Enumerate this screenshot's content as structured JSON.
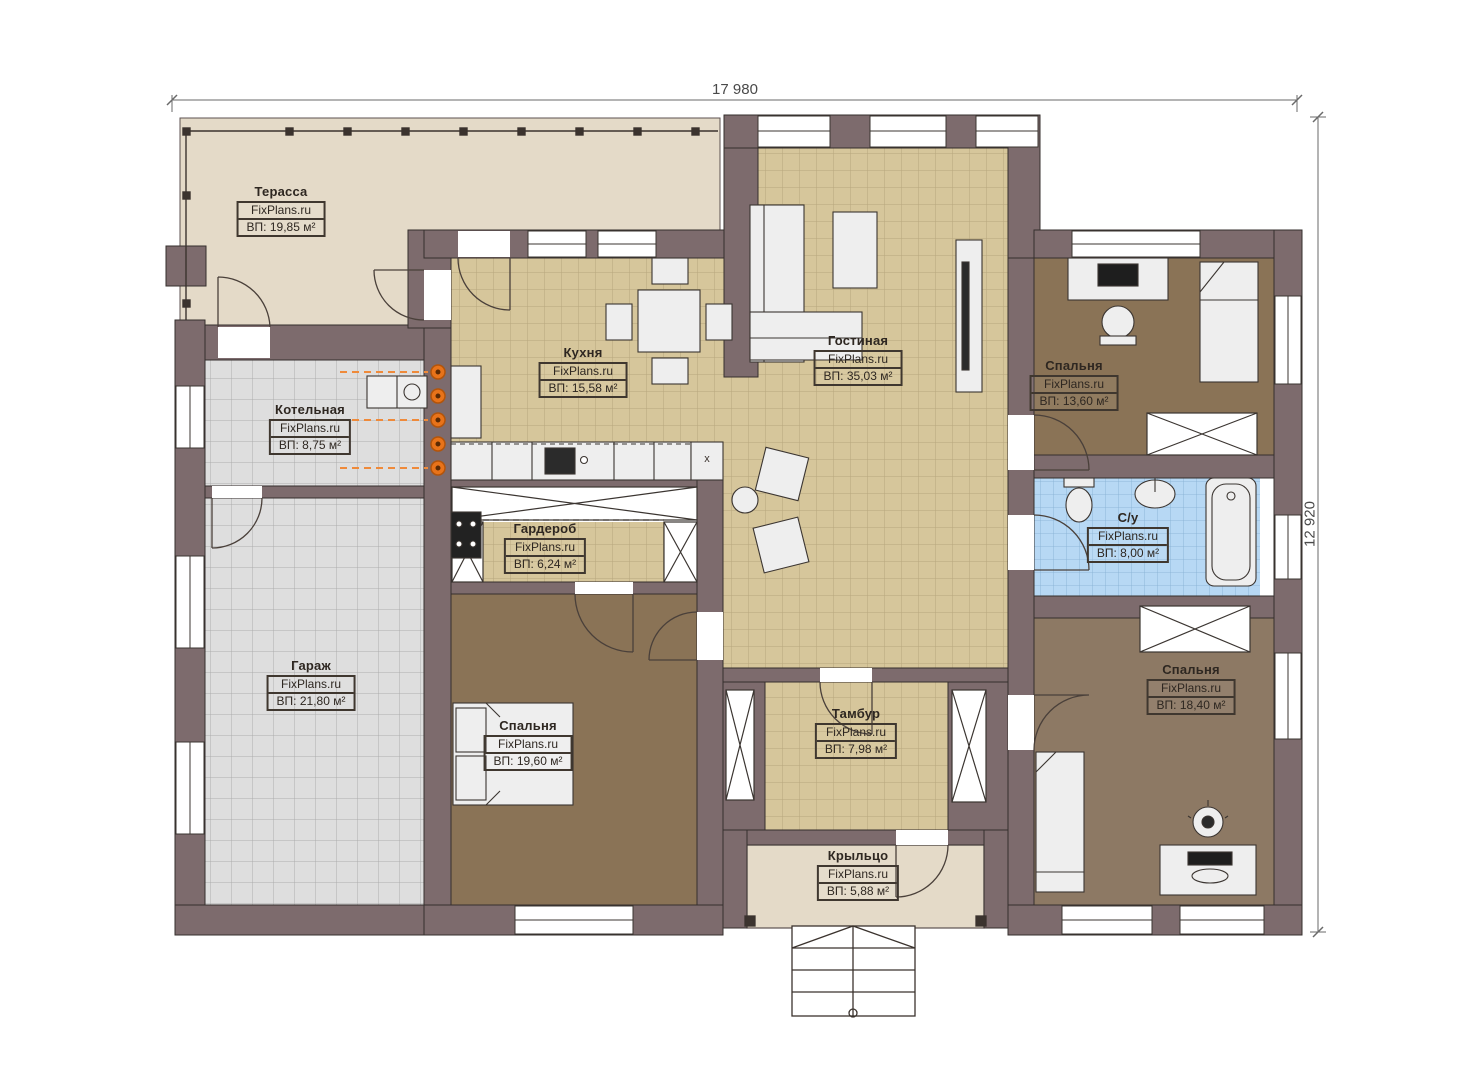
{
  "title": "Floor plan",
  "dimensions": {
    "top": "17 980",
    "right": "12 920"
  },
  "shaft": {
    "label": "x"
  },
  "watermark": "FixPlans.ru",
  "rooms": [
    {
      "id": "terrace",
      "name": "Терасса",
      "site": "FixPlans.ru",
      "area": "ВП: 19,85 м²"
    },
    {
      "id": "kitchen",
      "name": "Кухня",
      "site": "FixPlans.ru",
      "area": "ВП: 15,58 м²"
    },
    {
      "id": "living-room",
      "name": "Гостиная",
      "site": "FixPlans.ru",
      "area": "ВП: 35,03 м²"
    },
    {
      "id": "bedroom-top-right",
      "name": "Спальня",
      "site": "FixPlans.ru",
      "area": "ВП: 13,60 м²"
    },
    {
      "id": "boiler-room",
      "name": "Котельная",
      "site": "FixPlans.ru",
      "area": "ВП: 8,75 м²"
    },
    {
      "id": "wardrobe",
      "name": "Гардероб",
      "site": "FixPlans.ru",
      "area": "ВП: 6,24 м²"
    },
    {
      "id": "bathroom",
      "name": "С/у",
      "site": "FixPlans.ru",
      "area": "ВП: 8,00 м²"
    },
    {
      "id": "garage",
      "name": "Гараж",
      "site": "FixPlans.ru",
      "area": "ВП: 21,80 м²"
    },
    {
      "id": "bedroom-left",
      "name": "Спальня",
      "site": "FixPlans.ru",
      "area": "ВП: 19,60 м²"
    },
    {
      "id": "vestibule",
      "name": "Тамбур",
      "site": "FixPlans.ru",
      "area": "ВП: 7,98 м²"
    },
    {
      "id": "bedroom-bottom-right",
      "name": "Спальня",
      "site": "FixPlans.ru",
      "area": "ВП: 18,40 м²"
    },
    {
      "id": "porch",
      "name": "Крыльцо",
      "site": "FixPlans.ru",
      "area": "ВП: 5,88 м²"
    }
  ],
  "colors": {
    "wall": "#7d6b6d",
    "floor-tan": "#d6c69b",
    "floor-gray": "#dedede",
    "floor-brown": "#8a7356",
    "floor-brown2": "#8d7964",
    "floor-blue": "#b7d8f4",
    "floor-beige": "#e4dac8",
    "radiator": "#e8731a",
    "ink": "#3b332e"
  }
}
